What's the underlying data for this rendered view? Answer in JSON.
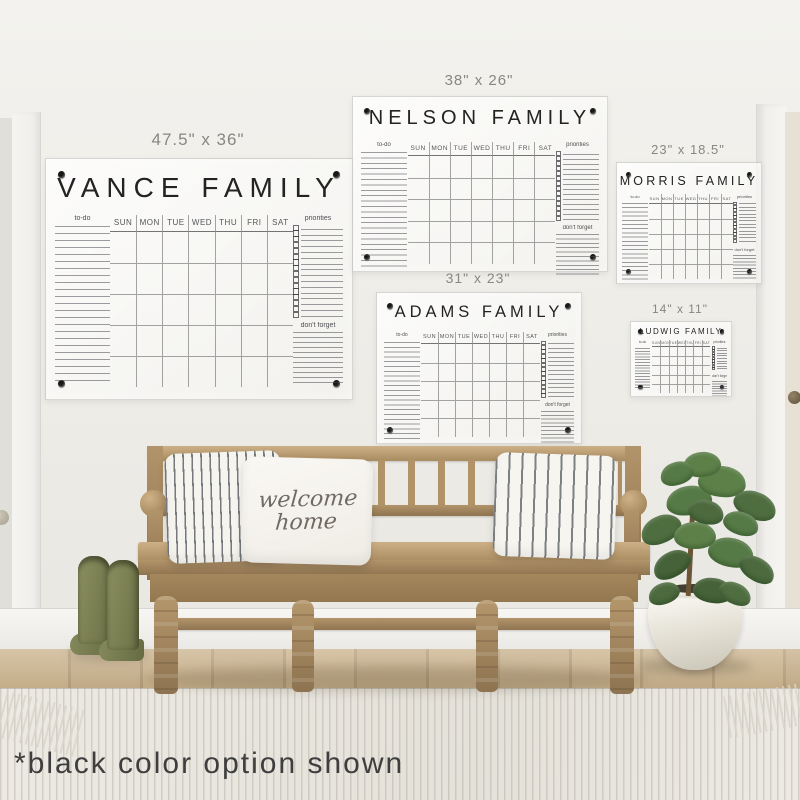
{
  "product_note": "*black color option shown",
  "panel_labels": {
    "todo": "to-do",
    "priorities": "priorities",
    "dont_forget": "don't forget",
    "days": [
      "SUN",
      "MON",
      "TUE",
      "WED",
      "THU",
      "FRI",
      "SAT"
    ]
  },
  "calendars": [
    {
      "id": "vance",
      "title": "VANCE FAMILY",
      "size_label": "47.5\" x 36\""
    },
    {
      "id": "nelson",
      "title": "NELSON FAMILY",
      "size_label": "38\" x 26\""
    },
    {
      "id": "morris",
      "title": "MORRIS FAMILY",
      "size_label": "23\" x 18.5\""
    },
    {
      "id": "adams",
      "title": "ADAMS FAMILY",
      "size_label": "31\" x 23\""
    },
    {
      "id": "ludwig",
      "title": "LUDWIG FAMILY",
      "size_label": "14\" x 11\""
    }
  ],
  "pillow_text": {
    "line1": "welcome",
    "line2": "home"
  },
  "colors": {
    "calendar_text": "#232323",
    "mount_hardware": "#181818",
    "wall": "#edebe6",
    "bench_wood": "#b5976c",
    "boots": "#7d8156",
    "plant_leaf": "#567a46",
    "rug": "#eceae3"
  }
}
